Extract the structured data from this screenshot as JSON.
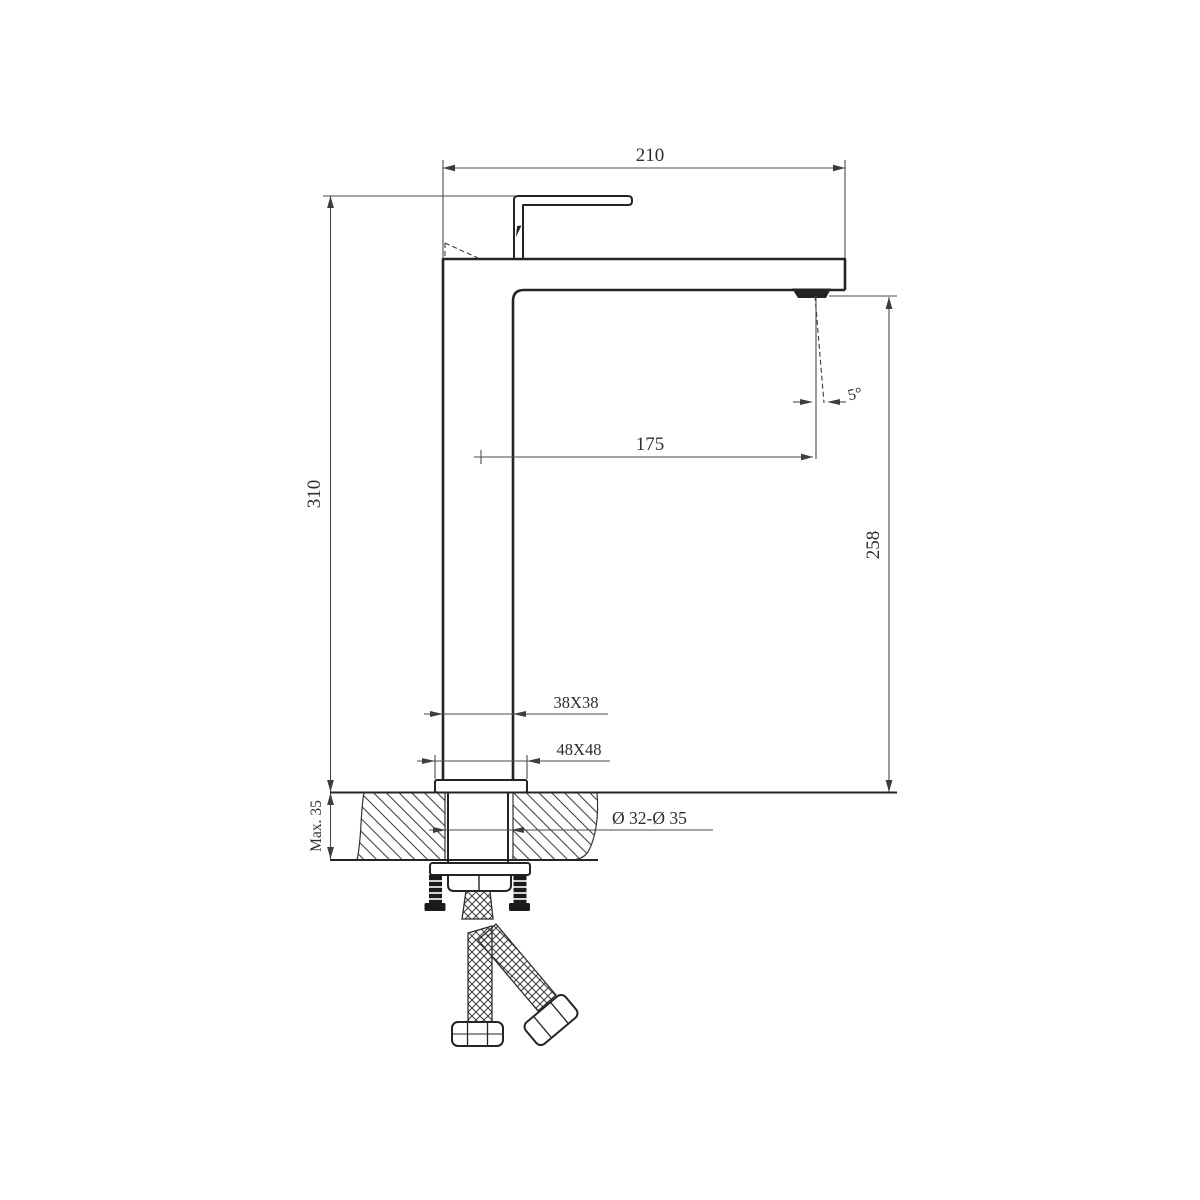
{
  "drawing": {
    "background_color": "#ffffff",
    "outline_color": "#242424",
    "dimension_color": "#4a4a4a",
    "hatch_color": "#3f3f3f",
    "labels": {
      "spout_overall_width": "210",
      "overall_height": "310",
      "spout_reach": "175",
      "outlet_height": "258",
      "outlet_angle": "5°",
      "body_cross_section": "38X38",
      "base_cross_section": "48X48",
      "max_deck_thickness": "Max. 35",
      "mounting_hole_diameter": "Ø 32-Ø 35"
    }
  }
}
